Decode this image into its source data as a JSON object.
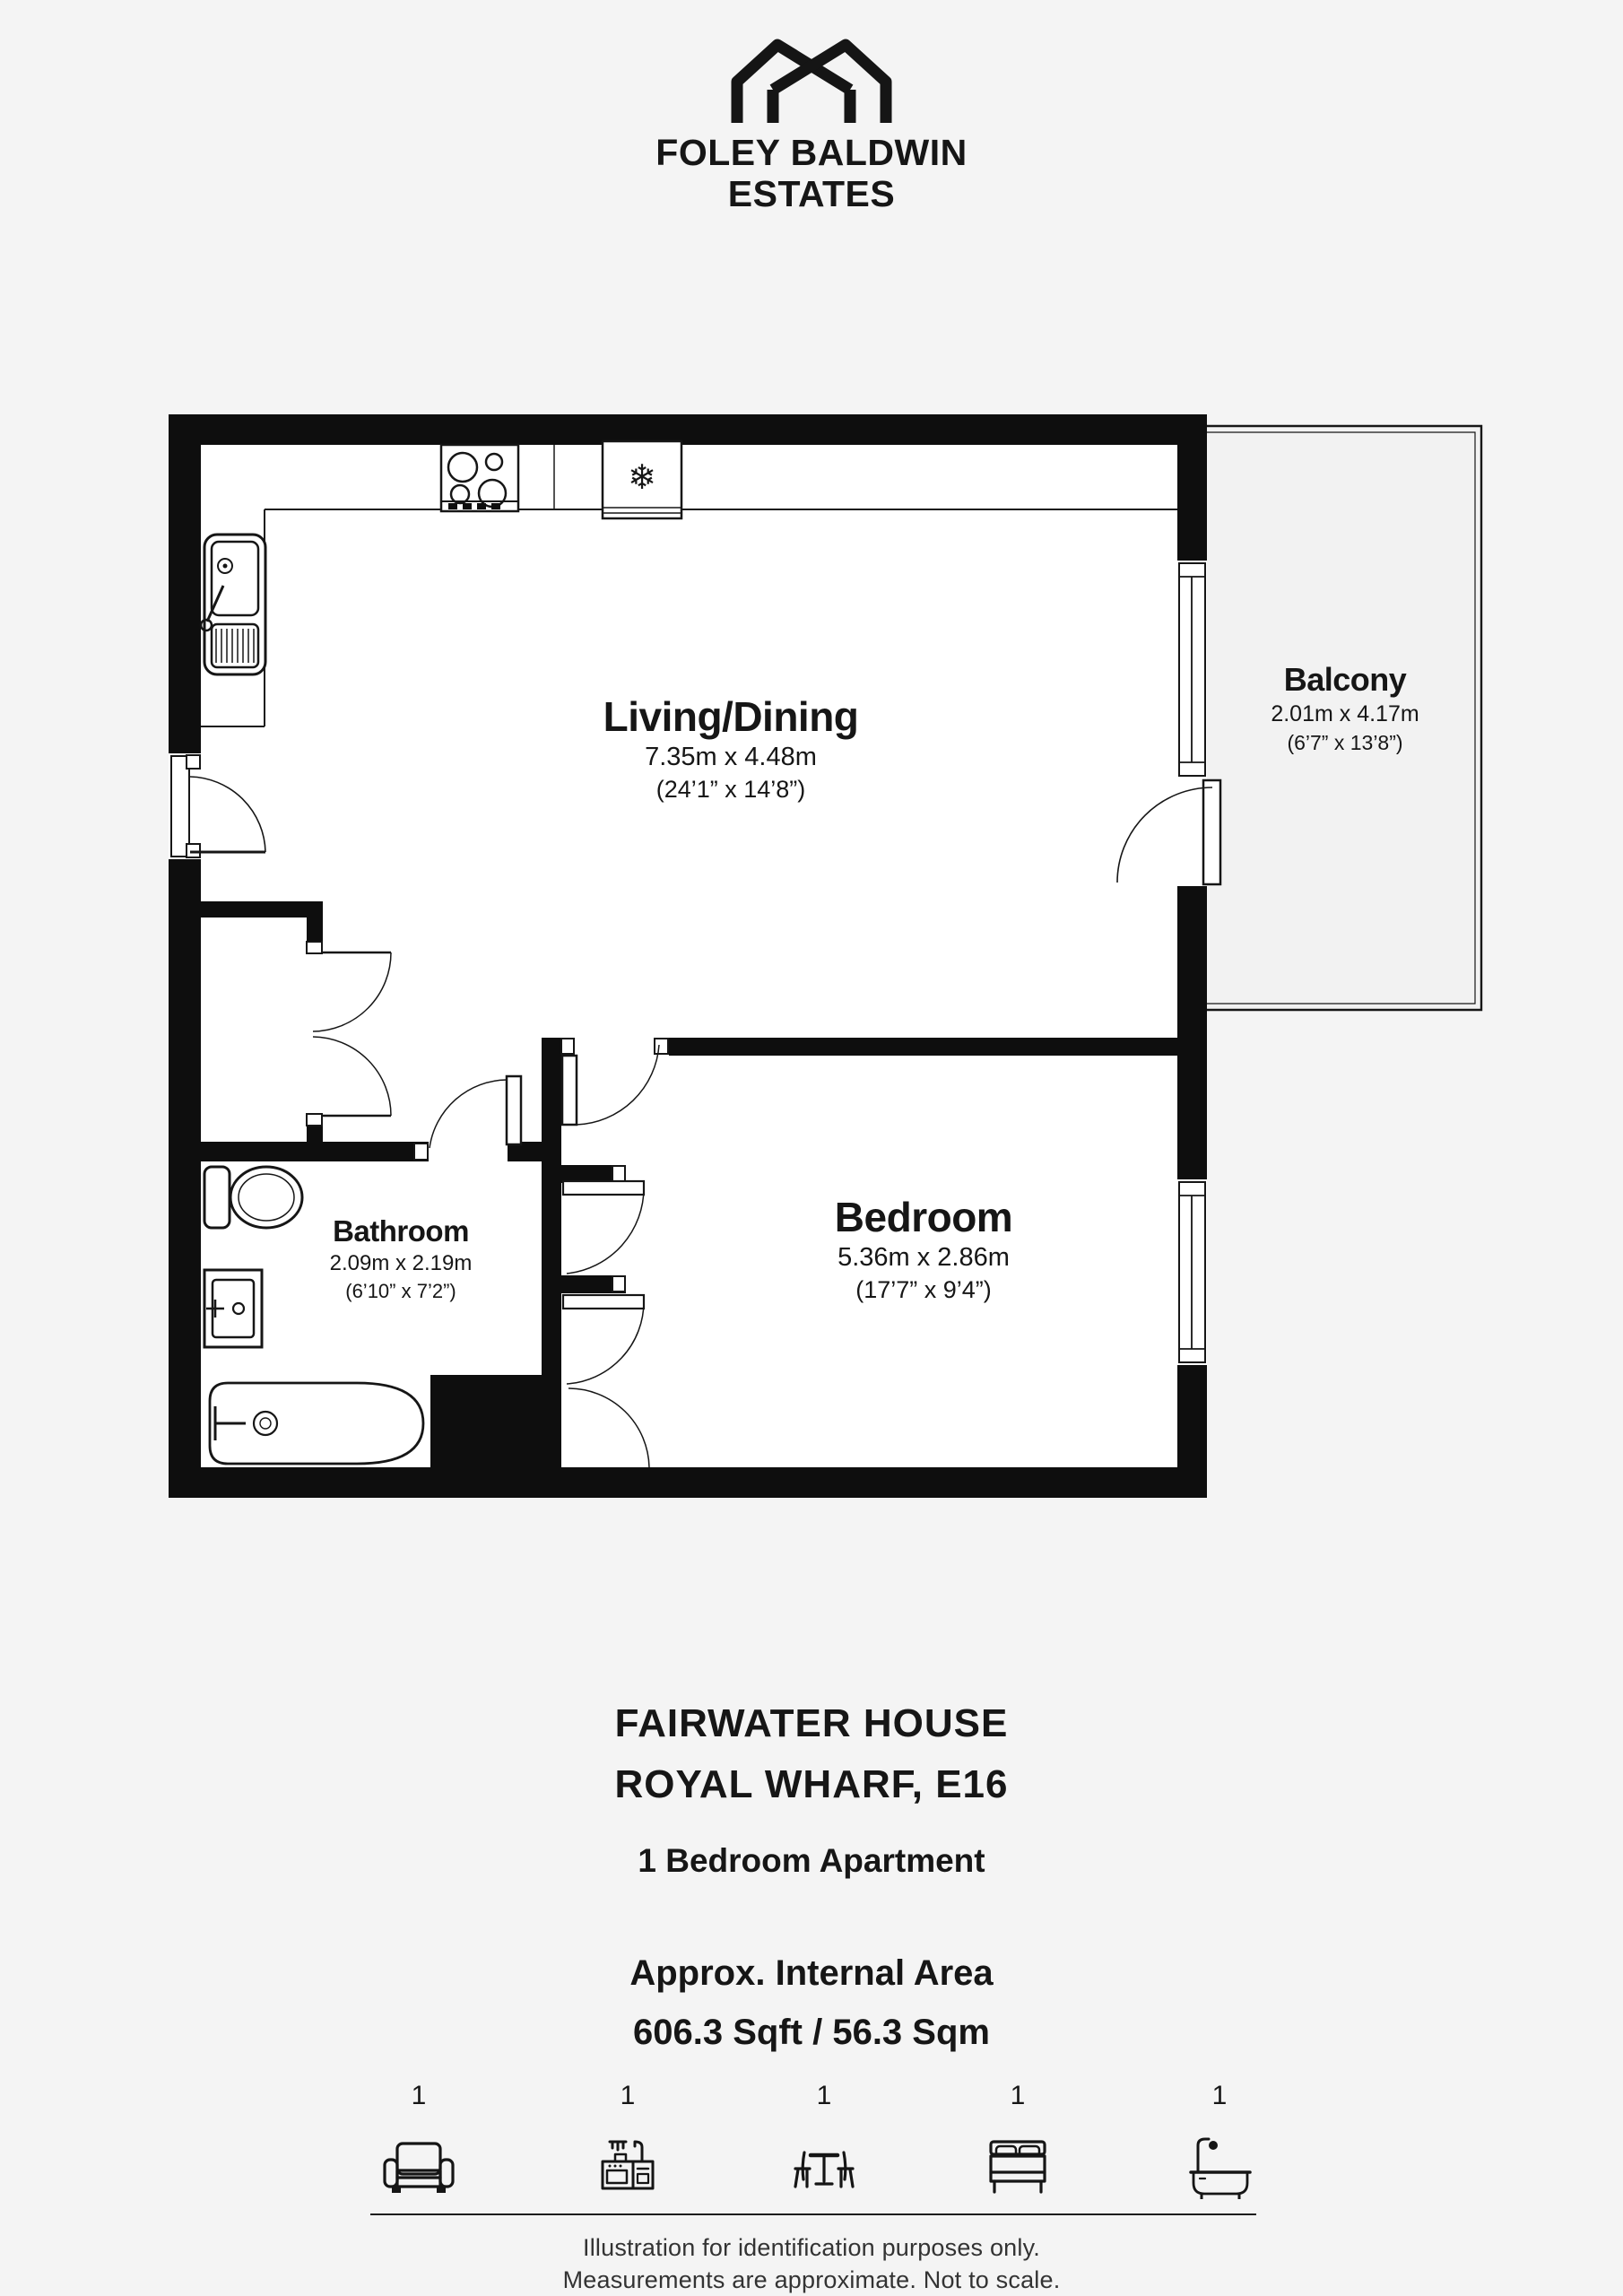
{
  "brand": {
    "line1": "FOLEY BALDWIN",
    "line2": "ESTATES"
  },
  "rooms": [
    {
      "name": "Living/Dining",
      "metric": "7.35m x 4.48m",
      "imperial": "(24’1” x 14’8”)"
    },
    {
      "name": "Balcony",
      "metric": "2.01m x 4.17m",
      "imperial": "(6’7” x 13’8”)"
    },
    {
      "name": "Bathroom",
      "metric": "2.09m x 2.19m",
      "imperial": "(6’10” x 7’2”)"
    },
    {
      "name": "Bedroom",
      "metric": "5.36m x 2.86m",
      "imperial": "(17’7” x 9’4”)"
    }
  ],
  "property": {
    "building": "FAIRWATER HOUSE",
    "address": "ROYAL WHARF, E16",
    "type": "1 Bedroom Apartment",
    "area_label": "Approx. Internal Area",
    "area_value": "606.3 Sqft / 56.3 Sqm"
  },
  "inventory": [
    {
      "item": "armchair",
      "count": "1"
    },
    {
      "item": "kitchen",
      "count": "1"
    },
    {
      "item": "dining-table",
      "count": "1"
    },
    {
      "item": "bed",
      "count": "1"
    },
    {
      "item": "bathtub",
      "count": "1"
    }
  ],
  "disclaimer": {
    "line1": "Illustration for identification purposes only.",
    "line2": "Measurements are approximate. Not to scale."
  },
  "icons": {
    "snowflake": "❄"
  },
  "colors": {
    "wall": "#0e0e0e",
    "background": "#f4f4f4",
    "room_fill": "#ffffff",
    "balcony_fill": "#f2f2f2",
    "line": "#161616"
  }
}
